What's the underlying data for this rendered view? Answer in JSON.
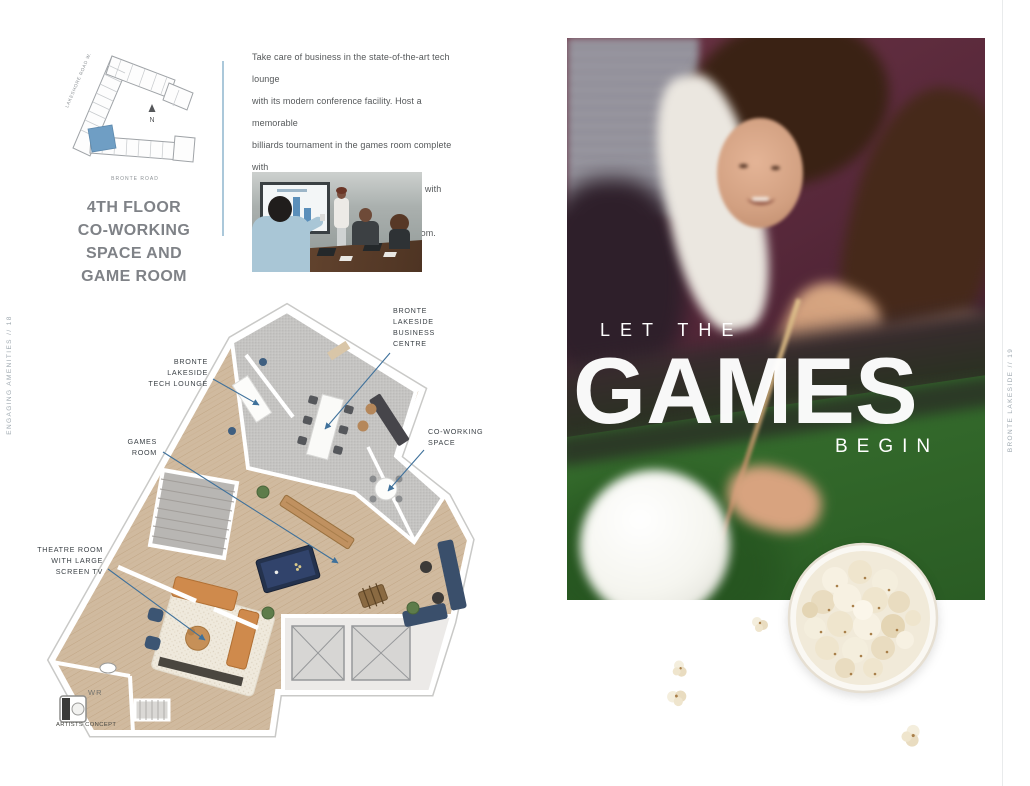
{
  "spread": {
    "left_edge_label": "ENGAGING AMENITIES // 18",
    "right_edge_label": "BRONTE LAKESIDE // 19"
  },
  "key_plan": {
    "street_left": "LAKESHORE ROAD W.",
    "street_bottom": "BRONTE ROAD",
    "north_label": "N"
  },
  "section": {
    "heading": "4TH FLOOR\nCO-WORKING\nSPACE AND\nGAME ROOM",
    "intro": "Take care of business in the state-of-the-art tech lounge\nwith its modern conference facility. Host a memorable\nbilliards tournament in the games room complete with\nshuffle board and foosball. Or, simply chill with friends,\npopcorn and drama in the cozy theatre room."
  },
  "floor_plan": {
    "label_business_centre": "BRONTE\nLAKESIDE\nBUSINESS\nCENTRE",
    "label_tech_lounge": "BRONTE\nLAKESIDE\nTECH LOUNGE",
    "label_games_room": "GAMES\nROOM",
    "label_co_working": "CO-WORKING\nSPACE",
    "label_theatre": "THEATRE ROOM\nWITH LARGE\nSCREEN TV",
    "label_washroom": "WR",
    "caption": "ARTISTS CONCEPT"
  },
  "hero": {
    "kicker": "LET THE",
    "headline": "GAMES",
    "tagline": "BEGIN"
  },
  "colors": {
    "leader_line": "#3f719b",
    "divider": "#abc8da",
    "heading_text": "#7f8287",
    "body_text": "#55585a",
    "felt_green": "#3a7330",
    "keyplan_highlight": "#6f9ec4"
  }
}
